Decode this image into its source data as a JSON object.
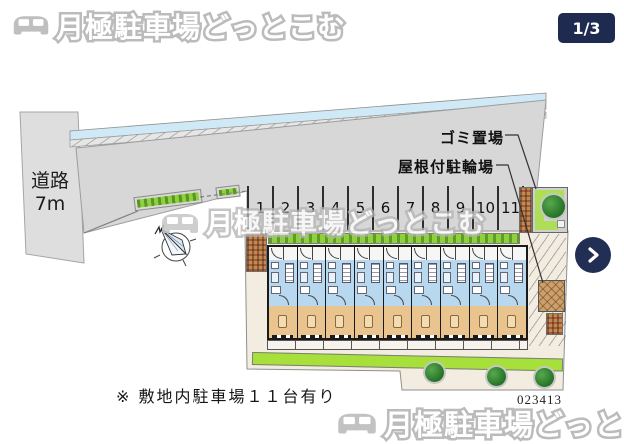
{
  "header": {
    "brand": "月極駐車場どっとこむ",
    "page_indicator": "1/3"
  },
  "watermark": {
    "text": "月極駐車場どっとこむ"
  },
  "map": {
    "road": {
      "line1": "道路",
      "line2": "7m"
    },
    "labels": {
      "garbage": "ゴミ置場",
      "bicycle": "屋根付駐輪場"
    },
    "parking": {
      "numbers": [
        "1",
        "2",
        "3",
        "4",
        "5",
        "6",
        "7",
        "8",
        "9",
        "10",
        "11"
      ]
    },
    "building": {
      "unit_count": 9
    },
    "note": "※ 敷地内駐車場１１台有り",
    "ref_number": "023413"
  },
  "nav": {
    "next_label": "next"
  },
  "colors": {
    "navy": "#1f2a50",
    "parcel_gray": "#d7d7d7",
    "street_blue": "#cfeaf6",
    "hedge_green": "#8fd13c",
    "building_blue": "#b7d8ef",
    "building_tan": "#e9c48e",
    "courtyard_cream": "#f2ece1"
  }
}
